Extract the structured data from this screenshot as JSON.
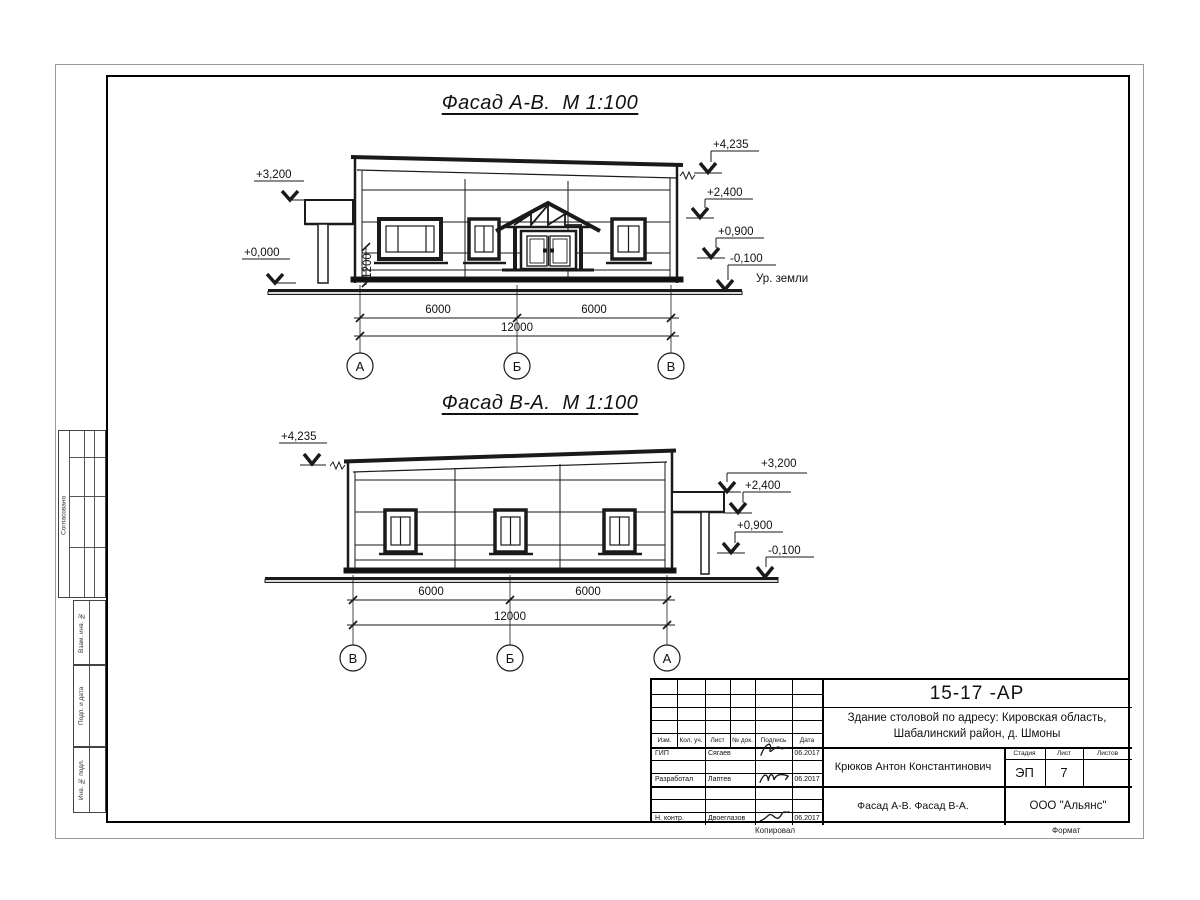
{
  "colors": {
    "line": "#1a1a1a",
    "joint": "#b5b5b5"
  },
  "facade1": {
    "title": "Фасад А-В.  М 1:100",
    "marks": {
      "m3200": "+3,200",
      "m0000": "+0,000",
      "m4235": "+4,235",
      "m2400": "+2,400",
      "m0900": "+0,900",
      "m0100": "-0,100",
      "ground": "Ур. земли",
      "h1200": "1200"
    },
    "dims": {
      "d1": "6000",
      "d2": "6000",
      "total": "12000"
    },
    "axes": [
      "А",
      "Б",
      "В"
    ]
  },
  "facade2": {
    "title": "Фасад В-А.  М 1:100",
    "marks": {
      "m4235": "+4,235",
      "m3200": "+3,200",
      "m2400": "+2,400",
      "m0900": "+0,900",
      "m0100": "-0,100"
    },
    "dims": {
      "d1": "6000",
      "d2": "6000",
      "total": "12000"
    },
    "axes": [
      "В",
      "Б",
      "А"
    ]
  },
  "titleblock": {
    "doc_number": "15-17 -АР",
    "project_line1": "Здание столовой по адресу: Кировская область,",
    "project_line2": "Шабалинский район, д. Шмоны",
    "author": "Крюков Антон Константинович",
    "sheet_title": "Фасад А-В. Фасад В-А.",
    "company": "ООО \"Альянс\"",
    "stage_label": "Стадия",
    "stage": "ЭП",
    "sheet_label": "Лист",
    "sheet_num": "7",
    "sheets_label": "Листов",
    "sheets_num": "",
    "cols": {
      "izm": "Изм.",
      "kol": "Кол. уч.",
      "list": "Лист",
      "doc": "№ док.",
      "sign": "Подпись",
      "date": "Дата"
    },
    "rows": [
      {
        "role": "ГИП",
        "name": "Сягаев",
        "date": "06.2017"
      },
      {
        "role": "Разработал",
        "name": "Лаптев",
        "date": "06.2017"
      },
      {
        "role": "Н. контр.",
        "name": "Двоеглазов",
        "date": "06.2017"
      }
    ],
    "kopiroval": "Копировал",
    "format": "Формат"
  },
  "side": {
    "soglasovano": "Согласовано",
    "vzam": "Взам. инв. №",
    "podp": "Подп. и дата",
    "inv": "Инв. № подл."
  }
}
